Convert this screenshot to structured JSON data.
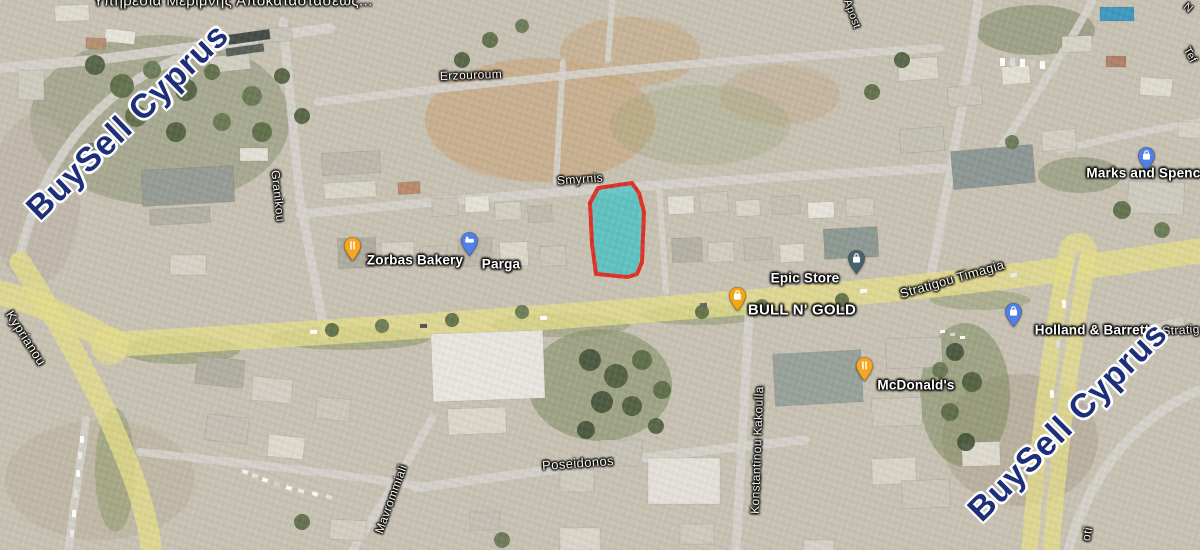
{
  "map": {
    "view_type": "satellite",
    "location_hint": "Larnaca, Cyprus"
  },
  "watermarks": [
    {
      "text": "BuySell Cyprus",
      "color": "#1e2f7a",
      "x": 128,
      "y": 122,
      "rot": -44,
      "size": 34
    },
    {
      "text": "BuySell Cyprus",
      "color": "#1e2f7a",
      "x": 1068,
      "y": 422,
      "rot": -45,
      "size": 34
    }
  ],
  "map_labels": [
    {
      "text": "Υπηρεσία Μερίμνης Αποκαταστάσεως...",
      "kind": "area-partial",
      "x": 233,
      "y": 1,
      "rot": 0,
      "size": 15
    },
    {
      "text": "Erzouroum",
      "kind": "street",
      "x": 471,
      "y": 75,
      "rot": -2,
      "size": 12
    },
    {
      "text": "Smyrnis",
      "kind": "street",
      "x": 580,
      "y": 179,
      "rot": -4,
      "size": 12
    },
    {
      "text": "Granikou",
      "kind": "street",
      "x": 278,
      "y": 196,
      "rot": 84,
      "size": 12
    },
    {
      "text": "Kyprianou",
      "kind": "street",
      "x": 26,
      "y": 338,
      "rot": 57,
      "size": 13
    },
    {
      "text": "Mavrommiali",
      "kind": "street",
      "x": 391,
      "y": 499,
      "rot": -70,
      "size": 12
    },
    {
      "text": "Konstantinou Kakoulla",
      "kind": "street",
      "x": 757,
      "y": 450,
      "rot": -88,
      "size": 12
    },
    {
      "text": "Poseidonos",
      "kind": "street",
      "x": 578,
      "y": 463,
      "rot": -4,
      "size": 13
    },
    {
      "text": "Stratigou Timagia",
      "kind": "street",
      "x": 952,
      "y": 279,
      "rot": -16,
      "size": 13
    },
    {
      "text": "Stratig",
      "kind": "street-fragment",
      "x": 1181,
      "y": 330,
      "rot": -3,
      "size": 12
    },
    {
      "text": "oti",
      "kind": "street-fragment",
      "x": 1087,
      "y": 534,
      "rot": -80,
      "size": 12
    },
    {
      "text": "Tef",
      "kind": "street-fragment",
      "x": 1190,
      "y": 55,
      "rot": 60,
      "size": 11
    },
    {
      "text": "N",
      "kind": "street-fragment",
      "x": 1188,
      "y": 8,
      "rot": 40,
      "size": 11
    },
    {
      "text": "Apost",
      "kind": "street-fragment",
      "x": 852,
      "y": 14,
      "rot": 70,
      "size": 11
    }
  ],
  "pois": [
    {
      "name": "Zorbas Bakery",
      "icon": "restaurant",
      "pin_color": "#F5A623",
      "label_x": 415,
      "label_y": 260,
      "pin_x": 352,
      "pin_y": 262
    },
    {
      "name": "Parga",
      "icon": "lodging",
      "pin_color": "#4F7FE8",
      "label_x": 501,
      "label_y": 264,
      "pin_x": 469,
      "pin_y": 257
    },
    {
      "name": "Epic Store",
      "icon": "shopping",
      "pin_color": "#47626E",
      "label_x": 805,
      "label_y": 278,
      "pin_x": 856,
      "pin_y": 275
    },
    {
      "name": "BULL N' GOLD",
      "icon": "shopping",
      "pin_color": "#F2A71B",
      "label_x": 802,
      "label_y": 310,
      "pin_x": 737,
      "pin_y": 312,
      "size": 15
    },
    {
      "name": "McDonald's",
      "icon": "restaurant",
      "pin_color": "#F5A623",
      "label_x": 916,
      "label_y": 385,
      "pin_x": 864,
      "pin_y": 382
    },
    {
      "name": "Holland & Barrett",
      "icon": "shopping",
      "pin_color": "#4F7FE8",
      "label_x": 1092,
      "label_y": 330,
      "pin_x": 1013,
      "pin_y": 328
    },
    {
      "name": "Marks and Spencer",
      "icon": "shopping",
      "pin_color": "#4F7FE8",
      "label_x": 1150,
      "label_y": 173,
      "pin_x": 1146,
      "pin_y": 172
    }
  ],
  "parcel": {
    "description": "highlighted property boundary",
    "fill": "#3FC7C9",
    "fill_opacity": 0.72,
    "stroke": "#E03127",
    "stroke_width": 4
  }
}
